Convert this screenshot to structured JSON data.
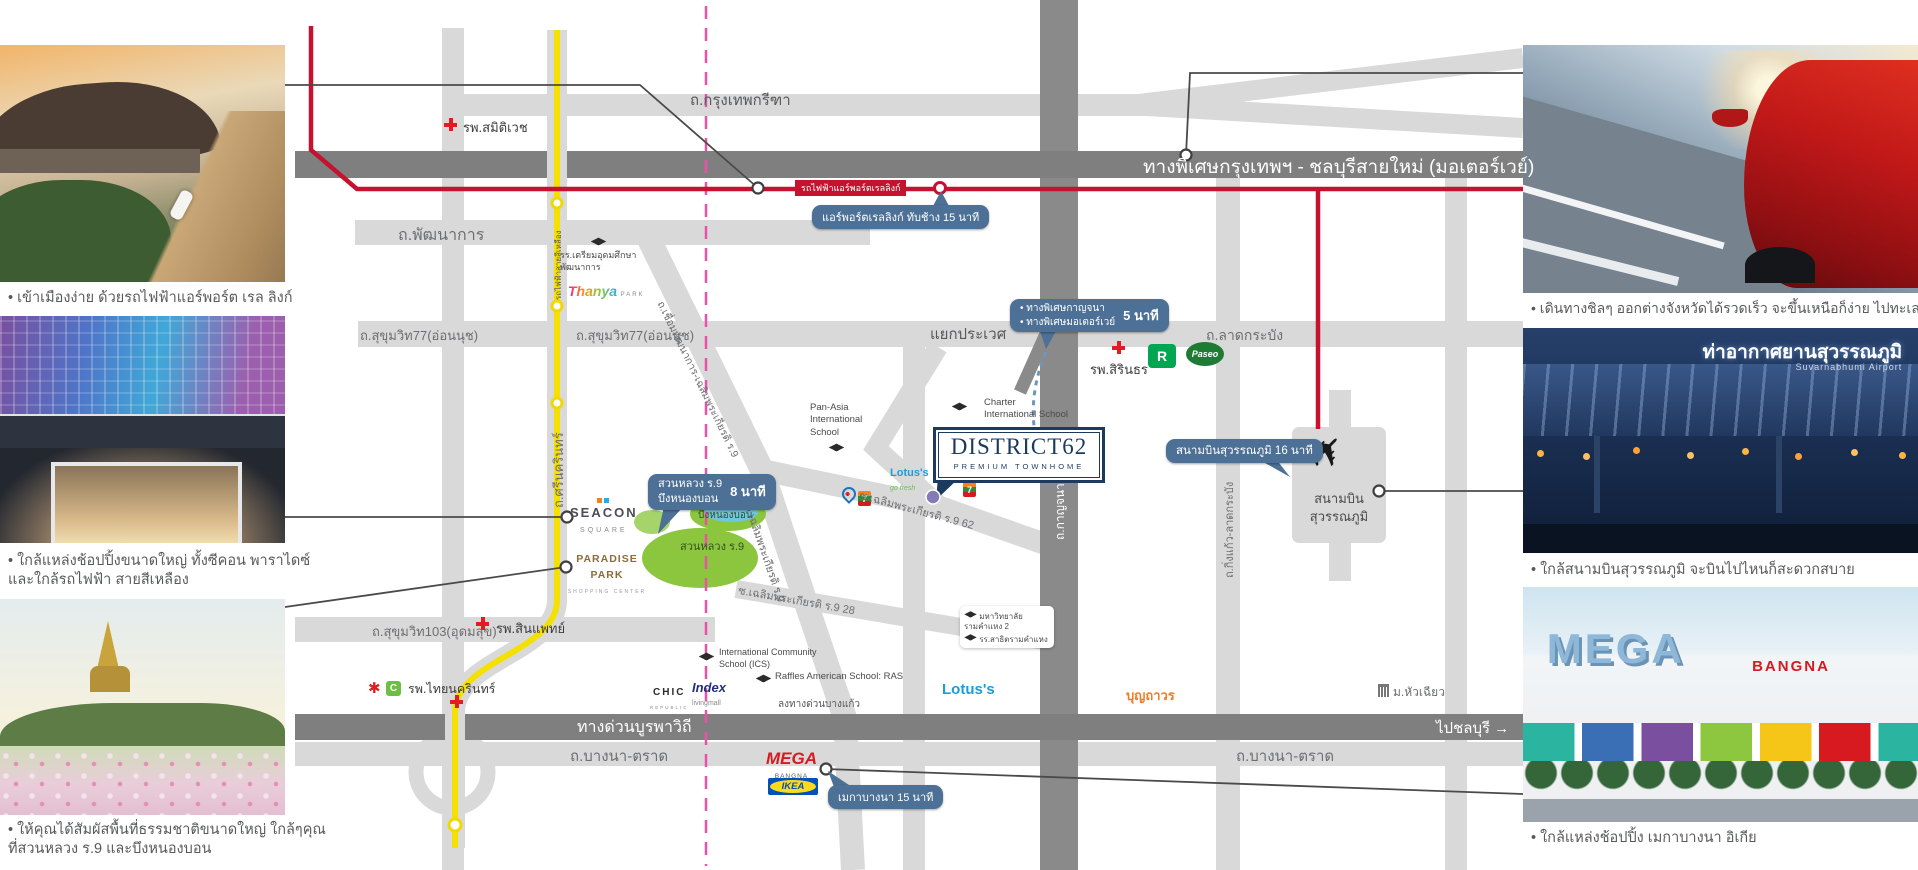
{
  "project": {
    "name": "DISTRICT62",
    "tagline": "PREMIUM TOWNHOME"
  },
  "colors": {
    "accent_navy": "#1c3a5e",
    "badge_blue": "#4d7096",
    "arl_red": "#c4122f",
    "yellow_line": "#f5e003",
    "boundary_pink": "#ea53a5"
  },
  "photos": {
    "left": [
      {
        "name": "airport-rail-link",
        "caption": "• เข้าเมืองง่าย ด้วยรถไฟฟ้าแอร์พอร์ต เรล ลิงก์"
      },
      {
        "name": "seacon-square",
        "caption_line1": "• ใกล้แหล่งช้อปปิ้งขนาดใหญ่ ทั้งซีคอน พาราไดซ์",
        "caption_line2": "และใกล้รถไฟฟ้า สายสีเหลือง"
      },
      {
        "name": "suan-luang-rama9",
        "caption_line1": "• ให้คุณได้สัมผัสพื้นที่ธรรมชาติขนาดใหญ่ ใกล้ๆคุณ",
        "caption_line2": "ที่สวนหลวง ร.9 และบึงหนองบอน"
      }
    ],
    "right": [
      {
        "name": "motorway-drive",
        "caption": "• เดินทางชิลๆ ออกต่างจังหวัดได้รวดเร็ว จะขึ้นเหนือก็ง่าย ไปทะเลก็ชิล"
      },
      {
        "name": "suvarnabhumi-airport",
        "caption": "• ใกล้สนามบินสุวรรณภูมิ จะบินไปไหนก็สะดวกสบาย",
        "sign_th": "ท่าอากาศยานสุวรรณภูมิ",
        "sign_en": "Suvarnabhumi Airport"
      },
      {
        "name": "mega-bangna",
        "caption": "• ใกล้แหล่งช้อปปิ้ง เมกาบางนา อิเกีย",
        "sign_mega": "MEGA",
        "sign_bangna": "BANGNA"
      }
    ]
  },
  "roads": {
    "krungthep_kreetha": "ถ.กรุงเทพกรีฑา",
    "motorway": "ทางพิเศษกรุงเทพฯ - ชลบุรีสายใหม่ (มอเตอร์เวย์)",
    "arl_line": "รถไฟฟ้าแอร์พอร์ตเรลลิงก์",
    "pattanakan": "ถ.พัฒนาการ",
    "sukhumvit77": "ถ.สุขุมวิท77(อ่อนนุช)",
    "prawet_junction": "แยกประเวศ",
    "lat_krabang": "ถ.ลาดกระบัง",
    "srinagarindra": "ถ.ศรีนครินทร์",
    "yellow_line": "รถไฟฟ้าสายสีเหลือง",
    "connector": "ถ.เชื่อมพัฒนาการ-เฉลิมพระเกียรติ ร.9",
    "chalermprakiat": "ถ.เฉลิมพระเกียรติ ร.9",
    "soi62": "ซ.เฉลิมพระเกียรติ ร.9 62",
    "soi28": "ซ.เฉลิมพระเกียรติ ร.9 28",
    "sukhumvit103": "ถ.สุขุมวิท103(อุดมสุข)",
    "burapha": "ทางด่วนบูรพาวิถี",
    "to_chonburi": "ไปชลบุรี →",
    "bangna_trat": "ถ.บางนา-ตราด",
    "king_kaew": "ถ.กิ่งแก้ว-ลาดกระบัง",
    "kanchanaphisek": "ถ.กาญจนาภิเษก",
    "bang_kaew_exit": "ลงทางด่วนบางแก้ว"
  },
  "badges": {
    "arl": {
      "text": "แอร์พอร์ตเรลลิงก์ ทับช้าง 15 นาที"
    },
    "expressway": {
      "line1": "• ทางพิเศษกาญจนา",
      "line2": "• ทางพิเศษมอเตอร์เวย์",
      "time": "5 นาที"
    },
    "parks": {
      "line1": "สวนหลวง ร.9",
      "line2": "บึงหนองบอน",
      "time": "8 นาที"
    },
    "airport": {
      "text": "สนามบินสุวรรณภูมิ 16 นาที"
    },
    "mega": {
      "text": "เมกาบางนา 15 นาที"
    }
  },
  "places": {
    "samitivej": "รพ.สมิติเวช",
    "sirindhorn": "รพ.สิรินธร",
    "sinphaet": "รพ.สินแพทย์",
    "thai_nakarin": "รพ.ไทยนครินทร์",
    "triam_udom_1": "รร.เตรียมอุดมศึกษา",
    "triam_udom_2": "พัฒนาการ",
    "pan_asia_1": "Pan-Asia",
    "pan_asia_2": "International",
    "pan_asia_3": "School",
    "charter_1": "Charter",
    "charter_2": "International School",
    "ics_1": "International Community",
    "ics_2": "School (ICS)",
    "raffles": "Raffles American School: RAS",
    "ram2_1": "มหาวิทยาลัย",
    "ram2_2": "รามคำแหง 2",
    "ram2_3": "รร.สาธิตรามคำแหง",
    "airport_1": "สนามบิน",
    "airport_2": "สุวรรณภูมิ",
    "suan_luang": "สวนหลวง ร.9",
    "nong_bon": "บึงหนองบอน",
    "hua_chiew": "ม.หัวเฉียว",
    "boonthavorn": "บุญถาวร"
  },
  "logos": {
    "seacon_1": "SEACON",
    "seacon_2": "SQUARE",
    "paradise_1": "PARADISE PARK",
    "paradise_2": "SHOPPING CENTER",
    "thanya_1": "Thanya",
    "thanya_2": "PARK",
    "lotus": "Lotus's",
    "lotus_sub": "go fresh",
    "lotus_big": "Lotus's",
    "mega_1": "MEGA",
    "mega_2": "BANGNA",
    "ikea": "IKEA",
    "chic_1": "CHIC",
    "chic_2": "REPUBLIC",
    "index_1": "Index",
    "index_2": "livingmall",
    "central": "✱",
    "big_c": "C",
    "robinson": "R",
    "seven": "7",
    "paseo": "Paseo"
  }
}
